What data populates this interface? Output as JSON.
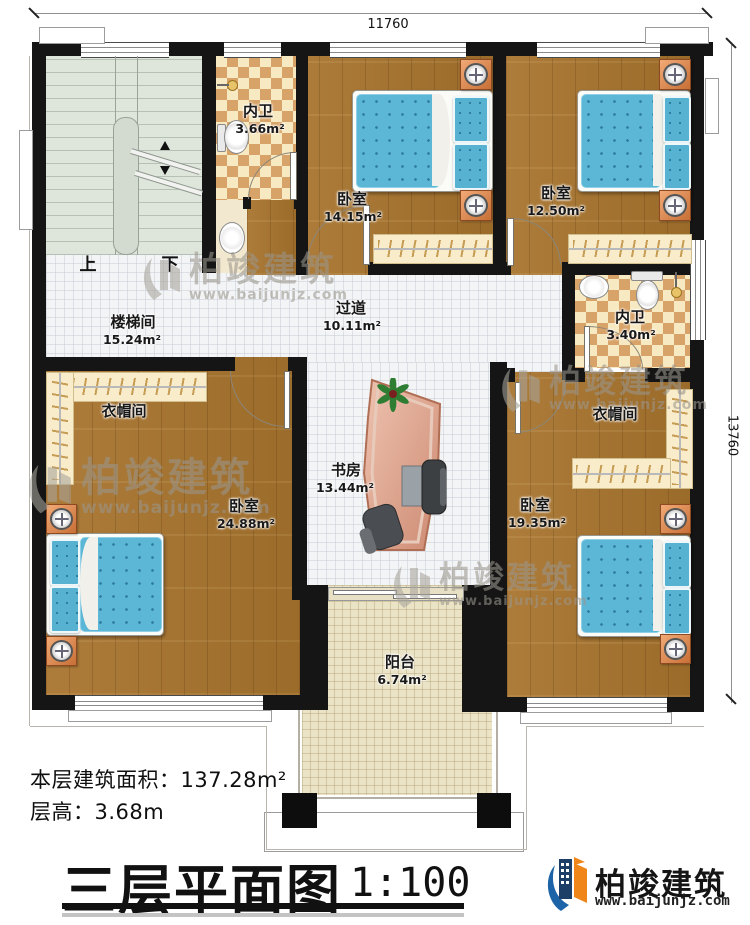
{
  "dimensions": {
    "top": "11760",
    "right": "13760"
  },
  "rooms": [
    {
      "name": "内卫",
      "area": "3.66m²"
    },
    {
      "name": "卧室",
      "area": "14.15m²"
    },
    {
      "name": "卧室",
      "area": "12.50m²"
    },
    {
      "name": "楼梯间",
      "area": "15.24m²"
    },
    {
      "name": "过道",
      "area": "10.11m²"
    },
    {
      "name": "内卫",
      "area": "3.40m²"
    },
    {
      "name": "衣帽间",
      "area": ""
    },
    {
      "name": "衣帽间",
      "area": ""
    },
    {
      "name": "卧室",
      "area": "24.88m²"
    },
    {
      "name": "书房",
      "area": "13.44m²"
    },
    {
      "name": "卧室",
      "area": "19.35m²"
    },
    {
      "name": "阳台",
      "area": "6.74m²"
    }
  ],
  "stairs": {
    "up": "上",
    "down": "下"
  },
  "info": {
    "floor_area_label": "本层建筑面积：",
    "floor_area_value": "137.28m²",
    "story_height_label": "层高：",
    "story_height_value": "3.68m"
  },
  "title": {
    "text": "三层平面图",
    "scale": "1:100"
  },
  "brand": {
    "name": "柏竣建筑",
    "website": "www.baijunjz.com"
  },
  "watermark": {
    "name": "柏竣建筑",
    "website": "www.baijunjz.com"
  },
  "colors": {
    "wall": "#151515",
    "wood": "#a8742e",
    "corridor_tile": "#f3f4f6",
    "balcony_tile": "#ebe3c6",
    "checker_dark": "#d8a368",
    "checker_light": "#f7e9c1",
    "stair": "#dee5db",
    "mattress": "#5cb6d6",
    "brand_orange": "#f08519",
    "brand_blue": "#1c63a8"
  }
}
